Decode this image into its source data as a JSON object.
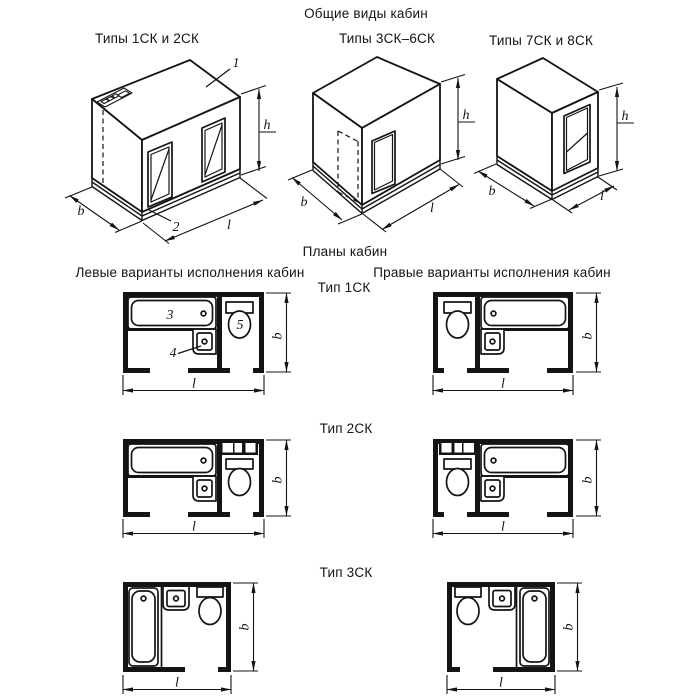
{
  "section_titles": {
    "views": "Общие виды кабин",
    "plans": "Планы кабин"
  },
  "column_headers": {
    "left": "Левые варианты исполнения кабин",
    "right": "Правые варианты исполнения кабин"
  },
  "view_labels": {
    "v1": "Типы 1СК и 2СК",
    "v2": "Типы 3СК–6СК",
    "v3": "Типы 7СК и 8СК"
  },
  "plan_type_labels": {
    "t1": "Тип 1СК",
    "t2": "Тип 2СК",
    "t3": "Тип 3СК"
  },
  "dimension_labels": {
    "height": "h",
    "width": "b",
    "length": "l"
  },
  "callouts": {
    "ceiling_panel": "1",
    "floor_base": "2",
    "bathtub": "3",
    "washbasin": "4",
    "toilet": "5"
  },
  "colors": {
    "ink": "#141414",
    "background": "#ffffff"
  }
}
